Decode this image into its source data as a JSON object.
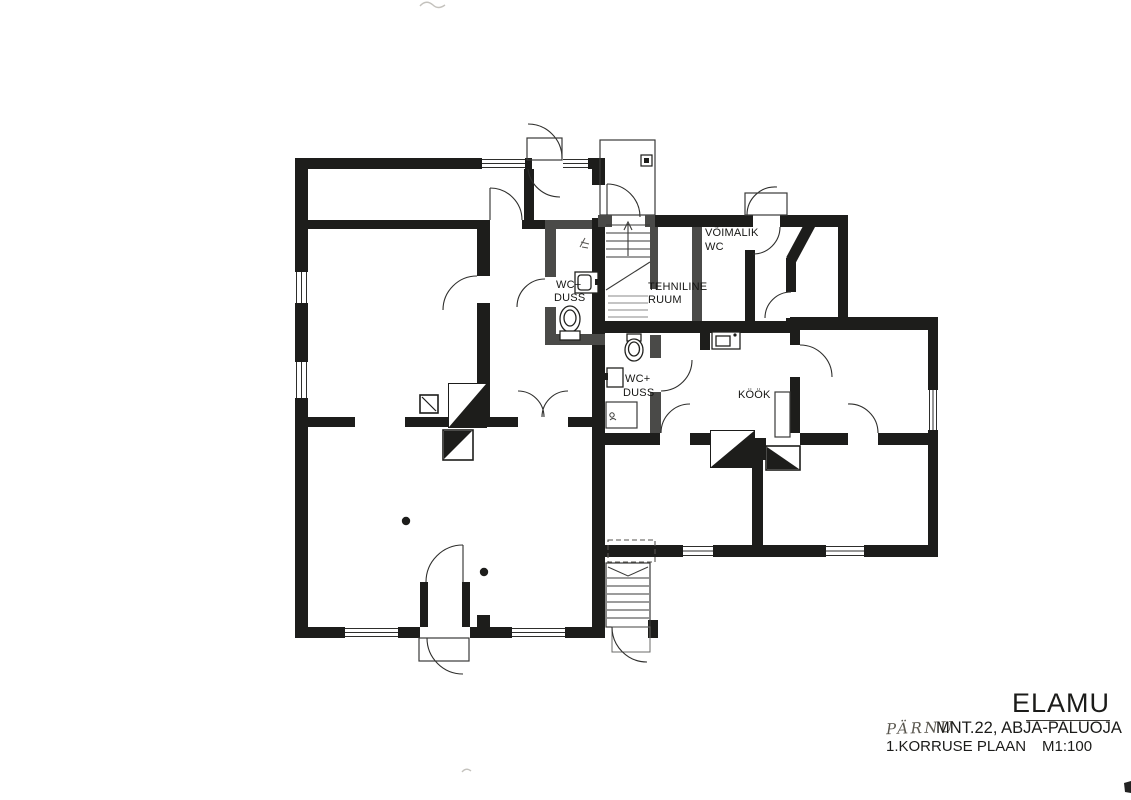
{
  "title_block": {
    "building": "ELAMU",
    "street_handwritten": "PÄRNU",
    "address": "MNT.22, ABJA-PALUOJA",
    "plan_name": "1.KORRUSE PLAAN",
    "scale": "M1:100"
  },
  "rooms": {
    "wc_duss_1": {
      "line1": "WC+",
      "line2": "DUSS"
    },
    "tehniline_ruum": {
      "line1": "TEHNILINE",
      "line2": "RUUM"
    },
    "voimalik_wc": {
      "line1": "VÕIMALIK",
      "line2": "WC"
    },
    "wc_duss_2": {
      "line1": "WC+",
      "line2": "DUSS"
    },
    "kook": {
      "label": "KÖÖK"
    }
  },
  "icons": {
    "toilet": "toilet-icon",
    "sink": "sink-icon",
    "shower": "shower-tray-icon",
    "stairs": "stairs-icon",
    "chimney": "chimney-flue-icon",
    "door_swing": "door-swing-arc",
    "window": "window-triple-line"
  },
  "colors": {
    "paper": "#ffffff",
    "wall": "#1d1d1b",
    "new_partition_wall": "#4a4a48",
    "thin_line": "#3a3a38",
    "handwriting": "#5a574f"
  }
}
